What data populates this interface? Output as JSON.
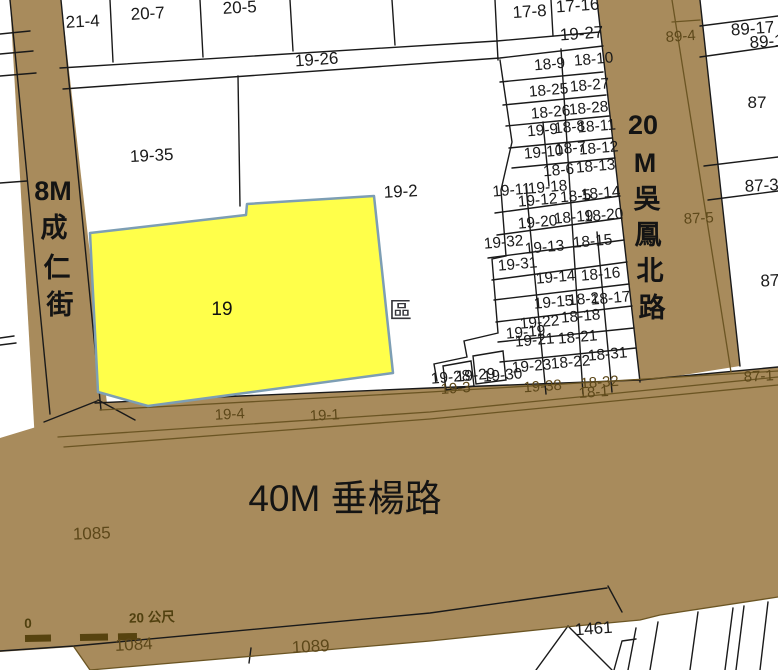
{
  "map": {
    "colors": {
      "road_fill": "#a88b5c",
      "road_line": "#6b5523",
      "road_text": "#5d481a",
      "parcel_line": "#1a1a1a",
      "highlight_fill": "#ffff4a",
      "highlight_border": "#7d9eb4",
      "district_text": "#35353b"
    },
    "highlight_parcel": {
      "number": "19"
    },
    "district": "東區",
    "road_names": {
      "left": "8M 成仁街",
      "right": "20M 吳鳳北路",
      "bottom": "40M 垂楊路"
    },
    "scalebar": {
      "start": "0",
      "end": "20 公尺"
    },
    "labels": [
      {
        "t": "21-4",
        "x": 83,
        "y": 27,
        "c": "pt"
      },
      {
        "t": "20-7",
        "x": 148,
        "y": 19,
        "c": "pt"
      },
      {
        "t": "20-5",
        "x": 240,
        "y": 13,
        "c": "pt"
      },
      {
        "t": "19-26",
        "x": 317,
        "y": 65,
        "c": "pt",
        "r": -4
      },
      {
        "t": "17-8",
        "x": 530,
        "y": 17,
        "c": "pt",
        "r": -4
      },
      {
        "t": "17-16",
        "x": 578,
        "y": 11,
        "c": "pt",
        "r": -4
      },
      {
        "t": "19-27",
        "x": 582,
        "y": 39,
        "c": "pt",
        "r": -4
      },
      {
        "t": "89-17",
        "x": 753,
        "y": 34,
        "c": "pt",
        "r": -4
      },
      {
        "t": "89-1",
        "x": 767,
        "y": 47,
        "c": "pt",
        "r": -4
      },
      {
        "t": "89-4",
        "x": 681,
        "y": 41,
        "c": "ol"
      },
      {
        "t": "87",
        "x": 757,
        "y": 108,
        "c": "pt",
        "r": 0
      },
      {
        "t": "87-3",
        "x": 762,
        "y": 191,
        "c": "pt"
      },
      {
        "t": "87-5",
        "x": 699,
        "y": 223,
        "c": "ol",
        "r": -3
      },
      {
        "t": "87-",
        "x": 773,
        "y": 286,
        "c": "pt"
      },
      {
        "t": "87-1",
        "x": 759,
        "y": 381,
        "c": "ol",
        "r": -3
      },
      {
        "t": "19-35",
        "x": 152,
        "y": 161,
        "c": "pt"
      },
      {
        "t": "19-2",
        "x": 401,
        "y": 197,
        "c": "pt"
      },
      {
        "t": "18-9",
        "x": 550,
        "y": 69,
        "c": "pl"
      },
      {
        "t": "18-10",
        "x": 594,
        "y": 64,
        "c": "pl"
      },
      {
        "t": "18-25",
        "x": 549,
        "y": 95,
        "c": "pl"
      },
      {
        "t": "18-27",
        "x": 590,
        "y": 90,
        "c": "pl"
      },
      {
        "t": "18-26",
        "x": 551,
        "y": 117,
        "c": "pl"
      },
      {
        "t": "18-28",
        "x": 589,
        "y": 113,
        "c": "pl"
      },
      {
        "t": "19-9",
        "x": 543,
        "y": 135,
        "c": "pl"
      },
      {
        "t": "18-8",
        "x": 570,
        "y": 132,
        "c": "pl"
      },
      {
        "t": "18-11",
        "x": 597,
        "y": 131,
        "c": "pl"
      },
      {
        "t": "19-10",
        "x": 544,
        "y": 157,
        "c": "pl"
      },
      {
        "t": "18-7",
        "x": 571,
        "y": 153,
        "c": "pl"
      },
      {
        "t": "18-12",
        "x": 599,
        "y": 153,
        "c": "pl"
      },
      {
        "t": "18-6",
        "x": 559,
        "y": 175,
        "c": "pl"
      },
      {
        "t": "18-13",
        "x": 596,
        "y": 171,
        "c": "pl"
      },
      {
        "t": "19-11",
        "x": 512,
        "y": 195,
        "c": "pl"
      },
      {
        "t": "19-18",
        "x": 548,
        "y": 192,
        "c": "pl"
      },
      {
        "t": "19-12",
        "x": 538,
        "y": 205,
        "c": "pl"
      },
      {
        "t": "18-5",
        "x": 576,
        "y": 201,
        "c": "pl"
      },
      {
        "t": "18-14",
        "x": 601,
        "y": 198,
        "c": "pl"
      },
      {
        "t": "19-20",
        "x": 538,
        "y": 227,
        "c": "pl"
      },
      {
        "t": "18-19",
        "x": 574,
        "y": 222,
        "c": "pl"
      },
      {
        "t": "18-20",
        "x": 604,
        "y": 220,
        "c": "pl"
      },
      {
        "t": "19-32",
        "x": 504,
        "y": 247,
        "c": "pl"
      },
      {
        "t": "19-13",
        "x": 545,
        "y": 252,
        "c": "pl"
      },
      {
        "t": "18-15",
        "x": 593,
        "y": 246,
        "c": "pl"
      },
      {
        "t": "19-31",
        "x": 518,
        "y": 269,
        "c": "pl"
      },
      {
        "t": "19-14",
        "x": 556,
        "y": 282,
        "c": "pl"
      },
      {
        "t": "18-16",
        "x": 601,
        "y": 279,
        "c": "pl"
      },
      {
        "t": "19-15",
        "x": 554,
        "y": 307,
        "c": "pl"
      },
      {
        "t": "18-2",
        "x": 584,
        "y": 304,
        "c": "pl"
      },
      {
        "t": "18-17",
        "x": 611,
        "y": 303,
        "c": "pl"
      },
      {
        "t": "19-22",
        "x": 540,
        "y": 327,
        "c": "pl"
      },
      {
        "t": "18-18",
        "x": 581,
        "y": 321,
        "c": "pl"
      },
      {
        "t": "19-19",
        "x": 526,
        "y": 337,
        "c": "pl"
      },
      {
        "t": "19-21",
        "x": 535,
        "y": 345,
        "c": "pl"
      },
      {
        "t": "18-21",
        "x": 578,
        "y": 342,
        "c": "pl"
      },
      {
        "t": "18-31",
        "x": 608,
        "y": 359,
        "c": "pl"
      },
      {
        "t": "19-23",
        "x": 532,
        "y": 371,
        "c": "pl"
      },
      {
        "t": "18-22",
        "x": 571,
        "y": 367,
        "c": "pl"
      },
      {
        "t": "19-28",
        "x": 451,
        "y": 382,
        "c": "pl"
      },
      {
        "t": "19-29",
        "x": 476,
        "y": 380,
        "c": "pl"
      },
      {
        "t": "19-30",
        "x": 503,
        "y": 380,
        "c": "pl"
      },
      {
        "t": "19-4",
        "x": 230,
        "y": 419,
        "c": "ol",
        "r": -3
      },
      {
        "t": "19-1",
        "x": 325,
        "y": 420,
        "c": "ol",
        "r": -3
      },
      {
        "t": "19-3",
        "x": 456,
        "y": 393,
        "c": "ol"
      },
      {
        "t": "19-38",
        "x": 543,
        "y": 391,
        "c": "ol"
      },
      {
        "t": "18-32",
        "x": 600,
        "y": 387,
        "c": "ol"
      },
      {
        "t": "18-1",
        "x": 594,
        "y": 397,
        "c": "ol"
      },
      {
        "t": "1085",
        "x": 92,
        "y": 539,
        "c": "ob",
        "r": -2
      },
      {
        "t": "1084",
        "x": 134,
        "y": 650,
        "c": "ob"
      },
      {
        "t": "1089",
        "x": 311,
        "y": 652,
        "c": "ob"
      },
      {
        "t": "1461",
        "x": 594,
        "y": 634,
        "c": "pt",
        "r": -4
      },
      {
        "t": "0",
        "x": 28,
        "y": 628,
        "c": "sc",
        "r": 0
      },
      {
        "t": "20 公尺",
        "x": 152,
        "y": 622,
        "c": "sc"
      },
      {
        "t": "8M",
        "x": 53,
        "y": 200,
        "c": "rd"
      },
      {
        "t": "成",
        "x": 54,
        "y": 237,
        "c": "rd"
      },
      {
        "t": "仁",
        "x": 57,
        "y": 277,
        "c": "rd"
      },
      {
        "t": "街",
        "x": 60,
        "y": 314,
        "c": "rd"
      },
      {
        "t": "20",
        "x": 643,
        "y": 134,
        "c": "rd"
      },
      {
        "t": "M",
        "x": 645,
        "y": 172,
        "c": "rd"
      },
      {
        "t": "吳",
        "x": 647,
        "y": 208,
        "c": "rd"
      },
      {
        "t": "鳳",
        "x": 648,
        "y": 244,
        "c": "rd"
      },
      {
        "t": "北",
        "x": 650,
        "y": 280,
        "c": "rd"
      },
      {
        "t": "路",
        "x": 652,
        "y": 317,
        "c": "rd"
      },
      {
        "t": "40M 垂楊路",
        "x": 345,
        "y": 511,
        "c": "rd40"
      },
      {
        "t": "東區",
        "x": 389,
        "y": 318,
        "c": "dist",
        "layer": "under"
      },
      {
        "t": "19",
        "x": 222,
        "y": 315,
        "c": "hl"
      }
    ]
  }
}
